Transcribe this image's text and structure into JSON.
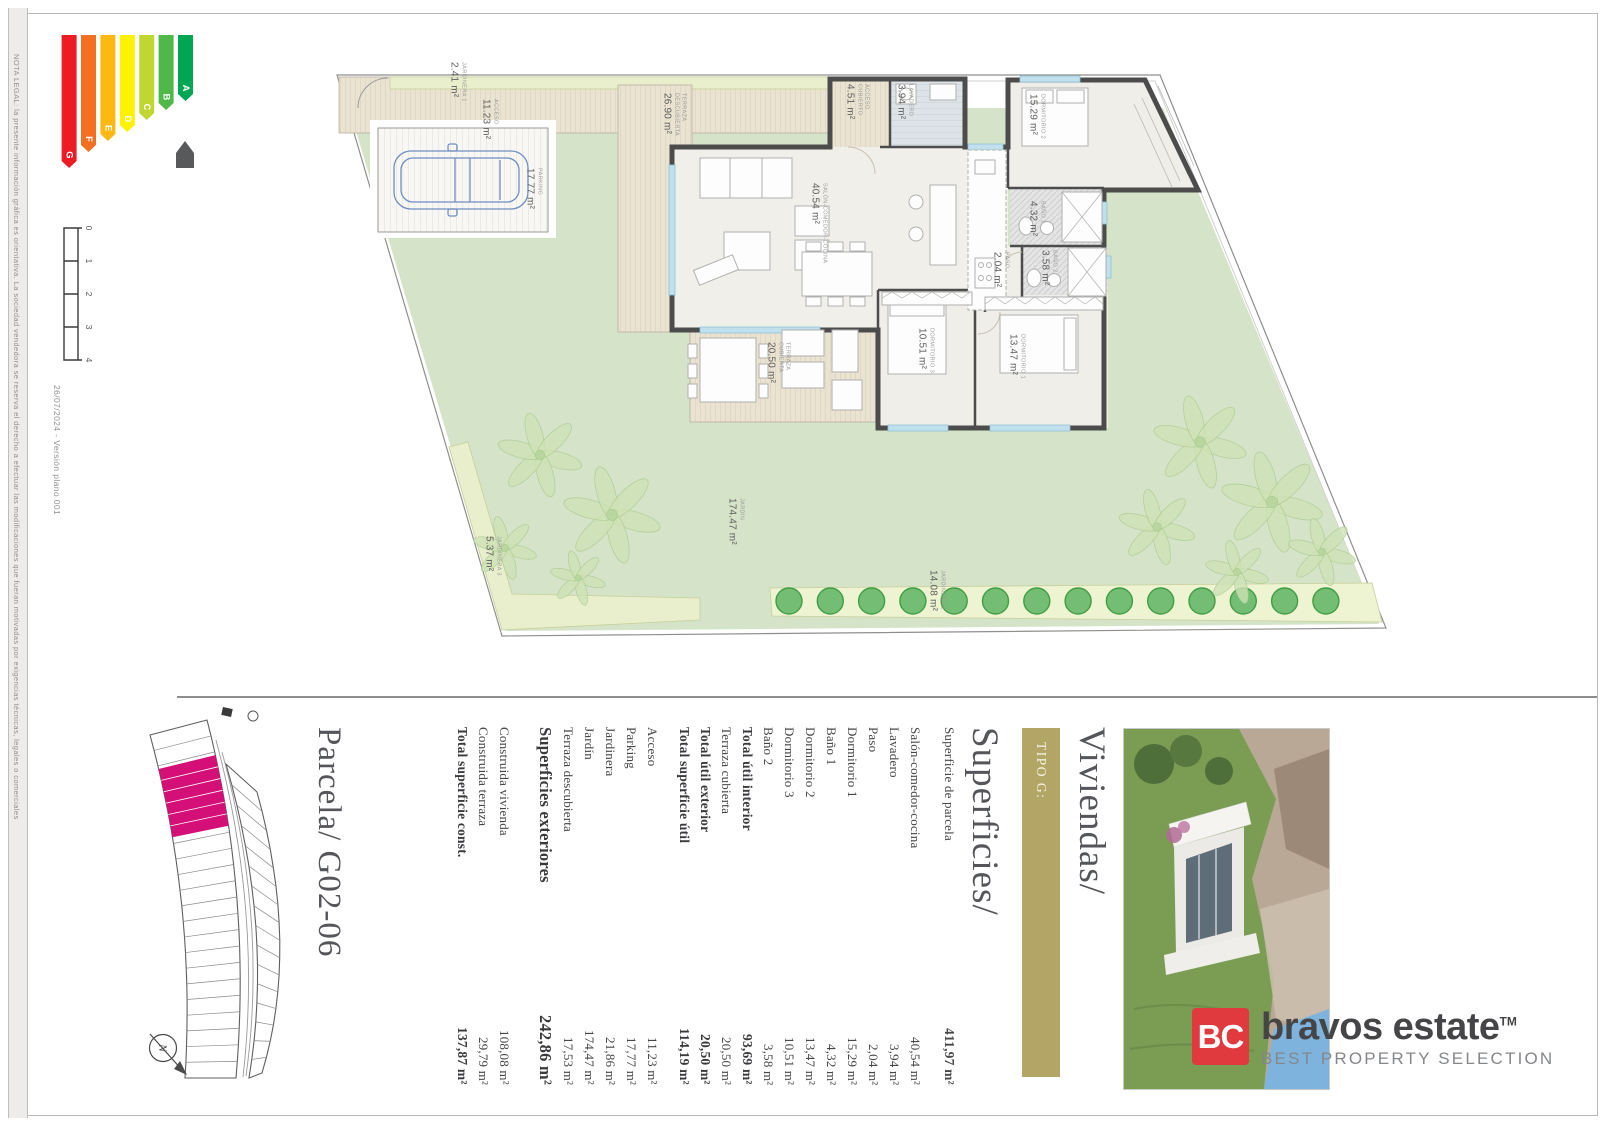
{
  "frame": {
    "legal_note": "NOTA LEGAL: la presente información gráfica es orientativa.  La sociedad vendedora se reserva el derecho a efectuar las modificaciones que fueran motivadas por exigencias técnicas, legales o comerciales",
    "version_note": "26/07/2024 - Versión plano 001"
  },
  "energy_label": {
    "bands": [
      {
        "letter": "A",
        "color": "#00a651",
        "length": 66
      },
      {
        "letter": "B",
        "color": "#50b848",
        "length": 75
      },
      {
        "letter": "C",
        "color": "#bfd730",
        "length": 85
      },
      {
        "letter": "D",
        "color": "#fff200",
        "length": 97
      },
      {
        "letter": "E",
        "color": "#fdb912",
        "length": 106
      },
      {
        "letter": "F",
        "color": "#f36f21",
        "length": 117
      },
      {
        "letter": "G",
        "color": "#ed1c24",
        "length": 133
      }
    ],
    "house_icon_color": "#58595b"
  },
  "scale_bar": {
    "ticks": [
      "0",
      "1",
      "2",
      "3",
      "4"
    ]
  },
  "floor_plan": {
    "rooms": [
      {
        "name": "JARDINERA 1",
        "area": "2.41 m²"
      },
      {
        "name": "ACCESO",
        "area": "11.23 m²"
      },
      {
        "name": "PARKING",
        "area": "17.77 m²"
      },
      {
        "name": "TERRAZA DESCUBIERTA",
        "area": "26.90 m²"
      },
      {
        "name": "ACCESO CUBIERTO",
        "area": "4.51 m²"
      },
      {
        "name": "LAVADERO",
        "area": "3.94 m²"
      },
      {
        "name": "SALÓN-COMEDOR-COCINA",
        "area": "40.54 m²"
      },
      {
        "name": "DORMITORIO 2",
        "area": "15.29 m²"
      },
      {
        "name": "BAÑO 1",
        "area": "4.32 m²"
      },
      {
        "name": "BAÑO 2",
        "area": "3.58 m²"
      },
      {
        "name": "PASO",
        "area": "2.04 m²"
      },
      {
        "name": "DORMITORIO 3",
        "area": "10.51 m²"
      },
      {
        "name": "DORMITORIO 1",
        "area": "13.47 m²"
      },
      {
        "name": "TERRAZA CUBIERTA",
        "area": "20.50 m²"
      },
      {
        "name": "JARDÍN",
        "area": "174.47 m²"
      },
      {
        "name": "JARDINERA 2",
        "area": "14.08 m²"
      },
      {
        "name": "JARDINERA 3",
        "area": "5.37 m²"
      }
    ]
  },
  "site_plan": {
    "title": "Parcela/ G02-06",
    "north_label": "N",
    "highlight_color": "#d40f77"
  },
  "panel": {
    "project_title": "Viviendas/",
    "type_label": "TIPO G:",
    "type_bar_color": "#b3a566",
    "section_title": "Superficies/",
    "rows": [
      {
        "label": "Superficie de parcela",
        "value": "411,97 m²"
      },
      {
        "label": "Salón-comedor-cocina",
        "value": "40,54 m²"
      },
      {
        "label": "Lavadero",
        "value": "3,94 m²"
      },
      {
        "label": "Paso",
        "value": "2,04 m²"
      },
      {
        "label": "Dormitorio 1",
        "value": "15,29 m²"
      },
      {
        "label": "Baño 1",
        "value": "4,32 m²"
      },
      {
        "label": "Dormitorio 2",
        "value": "13,47 m²"
      },
      {
        "label": "Dormitorio 3",
        "value": "10,51 m²"
      },
      {
        "label": "Baño 2",
        "value": "3,58 m²"
      },
      {
        "label": "Total útil interior",
        "value": "93,69 m²"
      },
      {
        "label": "Terraza cubierta",
        "value": "20,50 m²"
      },
      {
        "label": "Total útil exterior",
        "value": "20,50 m²"
      },
      {
        "label": "Total superficie útil",
        "value": "114,19 m²"
      },
      {
        "label": "Acceso",
        "value": "11,23 m²"
      },
      {
        "label": "Parking",
        "value": "17,77 m²"
      },
      {
        "label": "Jardinera",
        "value": "21,86 m²"
      },
      {
        "label": "Jardín",
        "value": "174,47 m²"
      },
      {
        "label": "Terraza descubierta",
        "value": "17,53 m²"
      },
      {
        "label": "Superficies exteriores",
        "value": "242,86 m²"
      },
      {
        "label": "Construida vivienda",
        "value": "108,08 m²"
      },
      {
        "label": "Construida terraza",
        "value": "29,79 m²"
      },
      {
        "label": "Total superficie const.",
        "value": "137,87 m²"
      }
    ]
  },
  "brand": {
    "initials": "BC",
    "name": "bravos estate",
    "trademark": "TM",
    "tagline": "BEST PROPERTY SELECTION",
    "red": "#e03a3e"
  }
}
